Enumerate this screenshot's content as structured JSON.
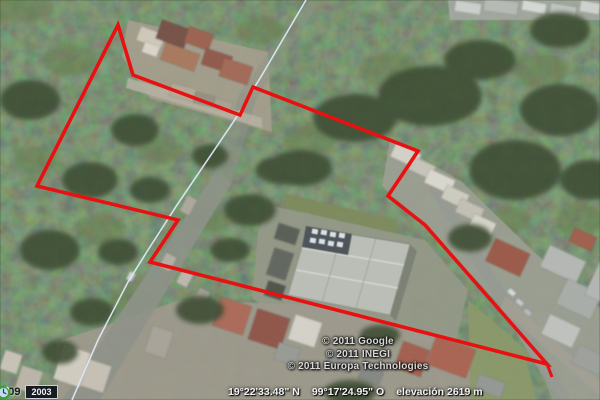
{
  "view": {
    "type": "satellite-aerial-imagery",
    "description": "Google Earth style aerial view of a wooded property outlined in red, with a warehouse building and surrounding houses"
  },
  "colors": {
    "property_outline": "#e81111",
    "street_centerline": "#dce7f7",
    "forest": "#2c4122",
    "warehouse_roof": "#b9beb2"
  },
  "property_outline": {
    "points": "118,25 133,75 240,115 253,87 418,151 388,196 425,225 547,364 150,262 178,220 37,186"
  },
  "street_centerline": {
    "points": "306,0 262,75 236,118 177,205 148,250 128,282 98,340 72,400"
  },
  "attribution": {
    "lines": [
      "© 2011 Google",
      "© 2011 INEGI",
      "© 2011 Europa Technologies"
    ]
  },
  "status_bar": {
    "coordinates_lat": "19°22'33.48\" N",
    "coordinates_lon": "99°17'24.95\" O",
    "elevation": "elevación 2619 m"
  },
  "timeline": {
    "left_year": "2009",
    "current_year": "2003",
    "icon": "historical-imagery-clock-icon"
  }
}
